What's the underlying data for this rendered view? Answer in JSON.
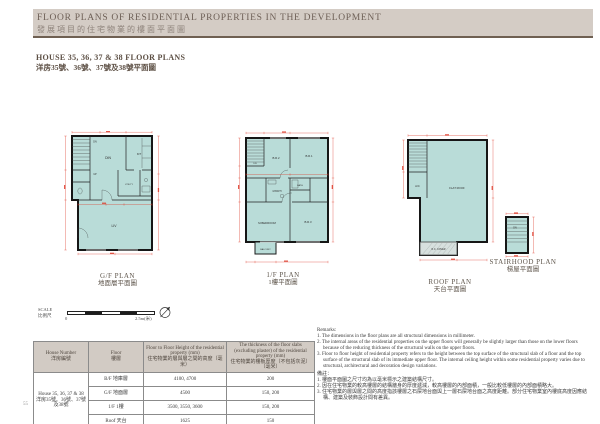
{
  "header": {
    "title_en": "FLOOR PLANS OF RESIDENTIAL PROPERTIES IN THE DEVELOPMENT",
    "title_zh": "發展項目的住宅物業的樓面平面圖"
  },
  "subtitle": {
    "en": "HOUSE 35, 36, 37 & 38 FLOOR PLANS",
    "zh": "洋房35號、36號、37號及38號平面圖"
  },
  "plans": {
    "gf": {
      "label_en": "G/F PLAN",
      "label_zh": "地面層平面圖",
      "rooms": {
        "dn": "DN",
        "up": "UP",
        "din": "DIN",
        "kit": "KIT",
        "utility": "UTILITY",
        "liv": "LIV"
      }
    },
    "f1": {
      "label_en": "1/F PLAN",
      "label_zh": "1樓平面圖",
      "rooms": {
        "dn": "DN",
        "br2": "B.R.2",
        "br1": "B.R.1",
        "mbath": "M.BATH",
        "bath": "BATH",
        "mbedroom": "M.BEDROOM",
        "br3": "B.R.3",
        "balcony": "BALCONY"
      }
    },
    "roof": {
      "label_en": "ROOF PLAN",
      "label_zh": "天台平面圖",
      "rooms": {
        "ac": "A/C",
        "flat_roof": "FLAT ROOF",
        "rc_cover": "R.C. COVER"
      }
    },
    "stairhood": {
      "label_en": "STAIRHOOD PLAN",
      "label_zh": "梯屋平面圖",
      "rooms": {
        "dn": "DN"
      }
    }
  },
  "scale": {
    "label_en": "SCALE",
    "label_zh": "比例尺",
    "start": "0",
    "end": "2.5m(米)"
  },
  "table": {
    "headers": {
      "house_en": "House Number",
      "house_zh": "洋房編號",
      "floor_en": "Floor",
      "floor_zh": "樓層",
      "height_en": "Floor to Floor Height of the residential property (mm)",
      "height_zh": "住宅物業的層與層之間的高度（毫米）",
      "slab_en": "The thickness of the floor slabs (excluding plaster) of the residential property (mm)",
      "slab_zh": "住宅物業的樓板厚度（不包括灰泥）（毫米）"
    },
    "house_en": "House 35, 36, 37 & 38",
    "house_zh": "洋房35號、36號、37號及38號",
    "rows": [
      {
        "floor": "B/F 地庫層",
        "height": "4100, 4700",
        "slab": "200"
      },
      {
        "floor": "G/F 地面層",
        "height": "4500",
        "slab": "150, 200"
      },
      {
        "floor": "1/F 1樓",
        "height": "3500, 3550, 3600",
        "slab": "150, 200"
      },
      {
        "floor": "Roof 天台",
        "height": "1625",
        "slab": "150"
      }
    ]
  },
  "remarks": {
    "title_en": "Remarks:",
    "items_en": [
      "1. The dimensions in the floor plans are all structural dimensions in millimeter.",
      "2. The internal areas of the residential properties on the upper floors will generally be slightly larger than those on the lower floors because of the reducing thickness of the structural walls on the upper floors.",
      "3. Floor to floor height of residential property refers to the height between the top surface of the structural slab of a floor and the top surface of the structural slab of its immediate upper floor. The internal ceiling height within some residential property varies due to structural, architectural and decoration design variations."
    ],
    "title_zh": "備註：",
    "items_zh": [
      "1. 樓面平面圖之尺寸均為以毫米標示之建築結構尺寸。",
      "2. 因在住宅物業的較高樓層的結構牆身的厚度遞減，較高樓層的內部面積，一般比較低樓層的內部面積略大。",
      "3. 住宅物業的層與層之間的高度指該樓層之石屎地台面與上一層石屎地台面之高度距離。部分住宅物業室內樓底高度因應結構、建築及裝飾設計間有差異。"
    ]
  },
  "page_number": "55"
}
